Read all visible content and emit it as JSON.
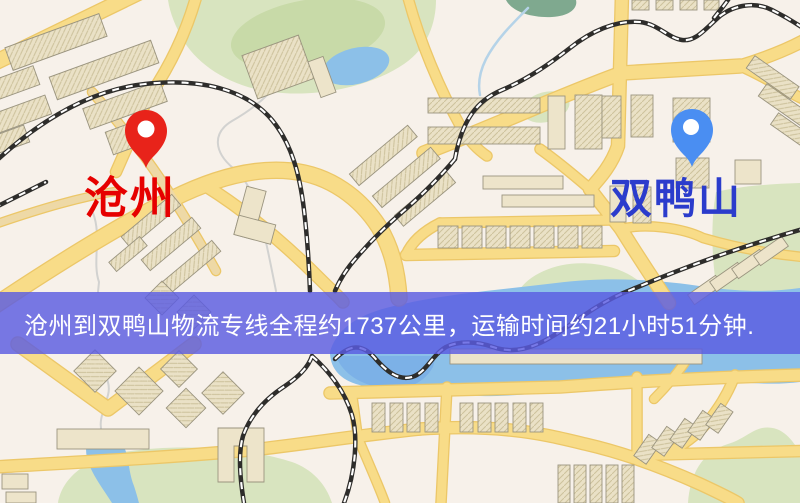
{
  "map": {
    "origin": {
      "label": "沧州"
    },
    "destination": {
      "label": "双鸭山"
    },
    "banner": {
      "text": "沧州到双鸭山物流专线全程约1737公里，运输时间约21小时51分钟.",
      "distance": "约1737公里",
      "duration": "约21小时51分钟"
    }
  },
  "icons": {
    "origin_pin": "map-pin",
    "destination_pin": "map-pin"
  },
  "colors": {
    "map_bg": "#f7f1ea",
    "road": "#f8dc88",
    "road_edge": "#ecc768",
    "road_tan": "#eed9a6",
    "park": "#d8e4bf",
    "park_dark": "#c8daa8",
    "water": "#8cc0e8",
    "water_deep": "#7cb1e7",
    "pond": "#7fa98f",
    "stream": "#d2d2d0",
    "stream_blue": "#b5d3e8",
    "railway": "#2e2d2b",
    "rail_dash": "#ffffff",
    "building": "#ede4ca",
    "building_line": "#9a947f",
    "banner_bg": "rgba(90,92,226,0.82)",
    "banner_text": "#ffffff",
    "origin_pin": "#e8231a",
    "origin_label": "#e60000",
    "dest_pin": "#4a8ef2",
    "dest_label": "#2b3ccc"
  }
}
